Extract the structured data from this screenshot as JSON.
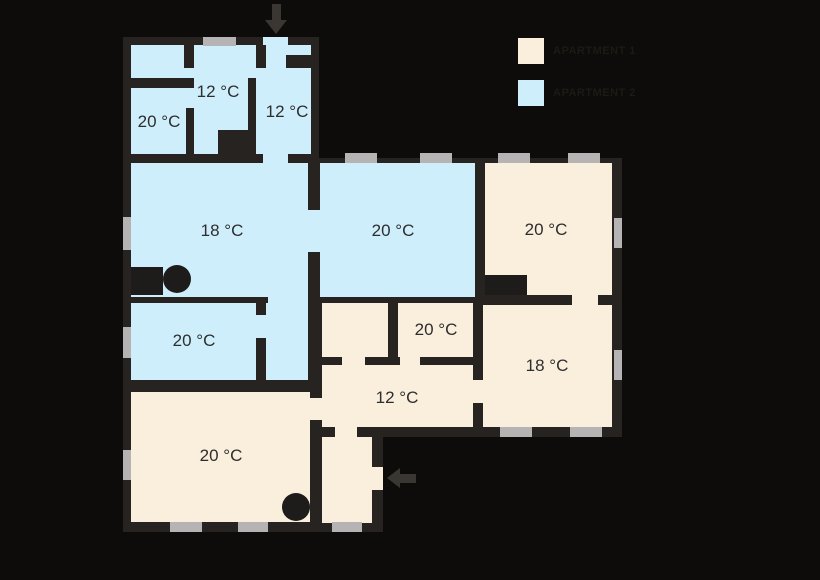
{
  "legend": {
    "items": [
      {
        "label": "APARTMENT 1",
        "color": "#faeedd"
      },
      {
        "label": "APARTMENT 2",
        "color": "#cfeefb"
      }
    ]
  },
  "colors": {
    "background": "#0d0c0a",
    "wall": "#262320",
    "apartment1_fill": "#faeedd",
    "apartment2_fill": "#cfeefb",
    "window": "#b5b3b3",
    "marker": "#1d1c1a",
    "arrow": "#3a3733",
    "label_text": "#2e2e2e"
  },
  "rooms": [
    {
      "name": "top-left-room",
      "apartment": 2,
      "temp": "20 °C"
    },
    {
      "name": "top-center-room",
      "apartment": 2,
      "temp": "12 °C"
    },
    {
      "name": "top-corridor",
      "apartment": 2,
      "temp": "12 °C"
    },
    {
      "name": "living-room-left",
      "apartment": 2,
      "temp": "18 °C"
    },
    {
      "name": "center-room",
      "apartment": 2,
      "temp": "20 °C"
    },
    {
      "name": "right-top-room",
      "apartment": 1,
      "temp": "20 °C"
    },
    {
      "name": "small-left-room",
      "apartment": 2,
      "temp": "20 °C"
    },
    {
      "name": "small-center-room",
      "apartment": 1,
      "temp": "20 °C"
    },
    {
      "name": "hallway",
      "apartment": 1,
      "temp": "12 °C"
    },
    {
      "name": "right-bottom-room",
      "apartment": 1,
      "temp": "18 °C"
    },
    {
      "name": "bottom-left-room",
      "apartment": 1,
      "temp": "20 °C"
    }
  ]
}
